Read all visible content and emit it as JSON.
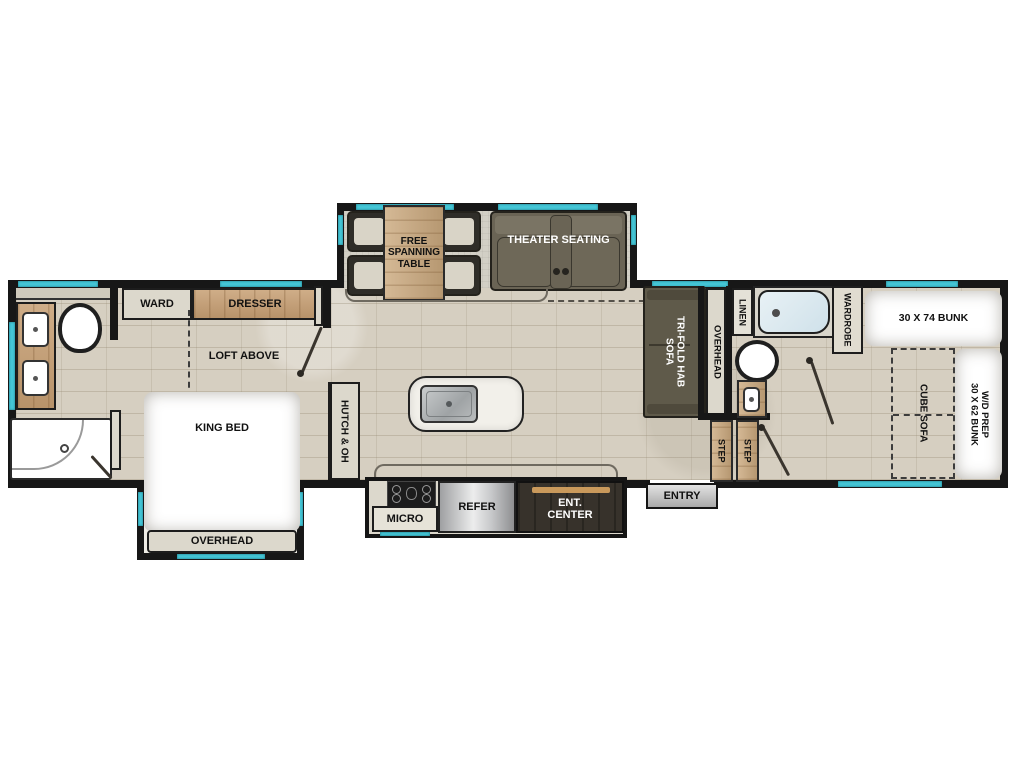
{
  "labels": {
    "ward": "WARD",
    "dresser": "DRESSER",
    "loft_above": "LOFT ABOVE",
    "king_bed": "KING BED",
    "bed_overhead": "OVERHEAD",
    "hutch": "HUTCH & OH",
    "free_spanning_table": "FREE\nSPANNING\nTABLE",
    "theater_seating": "THEATER SEATING",
    "micro": "MICRO",
    "refer": "REFER",
    "ent_center": "ENT.\nCENTER",
    "entry": "ENTRY",
    "step": "STEP",
    "trifold_sofa": "TRI-FOLD HAB\nSOFA",
    "rear_overhead": "OVERHEAD",
    "linen": "LINEN",
    "wardrobe": "WARDROBE",
    "bunk_30x74": "30 X 74 BUNK",
    "wd_bunk": "W/D PREP\n30 X 62 BUNK",
    "cube_sofa": "CUBE SOFA"
  },
  "colors": {
    "window_teal": "#45c6d6",
    "wall_black": "#171717",
    "wood": "#c79f73",
    "dark_furniture": "#645e4d",
    "floor_tile": "#d6cfc1",
    "tub_blue": "#dcebf1",
    "ent_center_dark": "#37322b",
    "tv_bar": "#c9995b"
  }
}
